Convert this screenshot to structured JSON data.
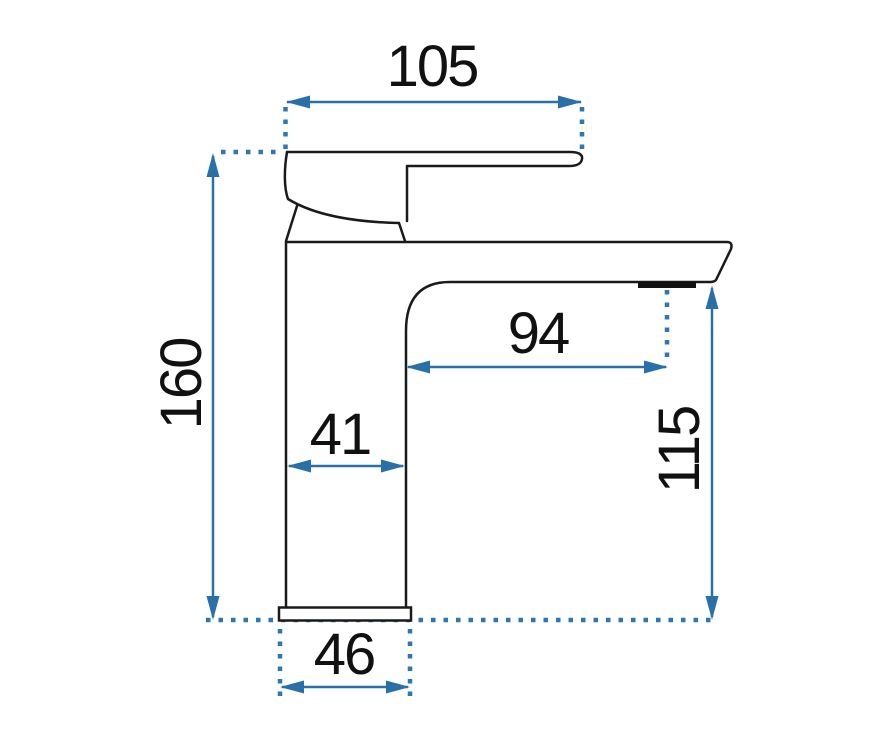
{
  "drawing": {
    "subject": "basin-mixer-faucet-side-view-technical-drawing",
    "colors": {
      "outline": "#1a1a1a",
      "dimension": "#2a70a8",
      "background": "#ffffff"
    },
    "dimensions": {
      "handle_width": "105",
      "total_height": "160",
      "spout_reach": "94",
      "body_width": "41",
      "spout_height": "115",
      "base_width": "46"
    }
  }
}
